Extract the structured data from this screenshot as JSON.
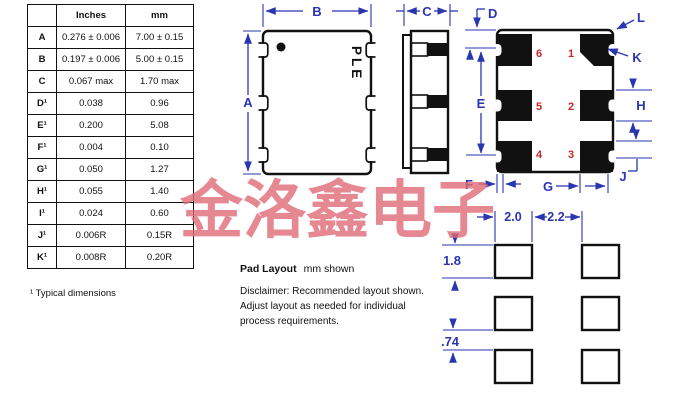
{
  "colors": {
    "drawing_line": "#111111",
    "dimension_blue": "#2a35b2",
    "pin_number_red": "#c62828",
    "watermark_pink": "#e06b78"
  },
  "dimension_table": {
    "headers": [
      "Inches",
      "mm"
    ],
    "rows": [
      {
        "label": "A",
        "inches": "0.276 ± 0.006",
        "mm": "7.00 ± 0.15"
      },
      {
        "label": "B",
        "inches": "0.197 ± 0.006",
        "mm": "5.00 ± 0.15"
      },
      {
        "label": "C",
        "inches": "0.067 max",
        "mm": "1.70 max"
      },
      {
        "label": "D¹",
        "inches": "0.038",
        "mm": "0.96"
      },
      {
        "label": "E¹",
        "inches": "0.200",
        "mm": "5.08"
      },
      {
        "label": "F¹",
        "inches": "0.004",
        "mm": "0.10"
      },
      {
        "label": "G¹",
        "inches": "0.050",
        "mm": "1.27"
      },
      {
        "label": "H¹",
        "inches": "0.055",
        "mm": "1.40"
      },
      {
        "label": "I¹",
        "inches": "0.024",
        "mm": "0.60"
      },
      {
        "label": "J¹",
        "inches": "0.006R",
        "mm": "0.15R"
      },
      {
        "label": "K¹",
        "inches": "0.008R",
        "mm": "0.20R"
      }
    ],
    "footnote": "¹ Typical dimensions"
  },
  "package_drawing": {
    "marking": "PLE",
    "dim_labels": {
      "A": "A",
      "B": "B",
      "C": "C",
      "D": "D",
      "E": "E",
      "F": "F",
      "G": "G",
      "H": "H",
      "J": "J",
      "K": "K",
      "L": "L"
    }
  },
  "pin_layout": {
    "pins": [
      "1",
      "2",
      "3",
      "4",
      "5",
      "6"
    ]
  },
  "pad_layout": {
    "title": "Pad Layout",
    "units_note": "mm shown",
    "disclaimer": "Disclaimer: Recommended layout shown.\nAdjust layout as needed for individual\nprocess requirements.",
    "dims": {
      "pad_width": "2.0",
      "column_gap": "2.2",
      "pad_height": "1.8",
      "row_gap": ".74"
    }
  },
  "watermark": {
    "text": "金洛鑫电子"
  }
}
